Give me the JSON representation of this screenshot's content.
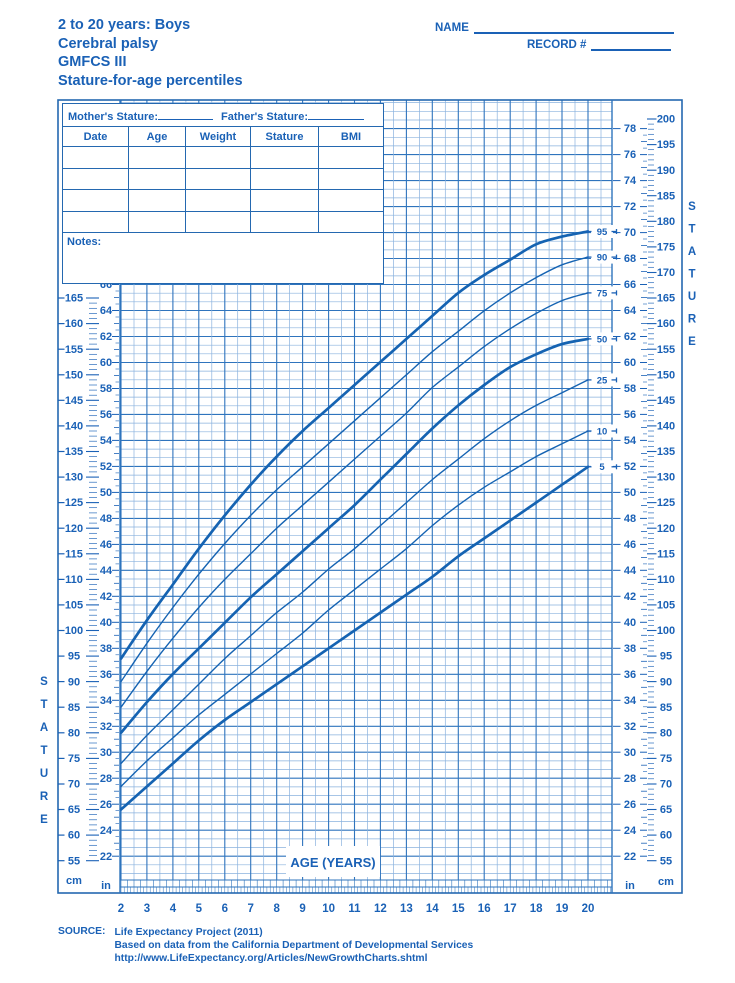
{
  "header": {
    "title_line1": "2 to 20 years: Boys",
    "title_line2": "Cerebral palsy",
    "title_line3": "GMFCS III",
    "title_line4": "Stature-for-age percentiles",
    "name_label": "NAME",
    "record_label": "RECORD #"
  },
  "entry_table": {
    "mother_label": "Mother's Stature:",
    "father_label": "Father's Stature:",
    "columns": [
      "Date",
      "Age",
      "Weight",
      "Stature",
      "BMI"
    ],
    "empty_rows": 4,
    "notes_label": "Notes:"
  },
  "colors": {
    "accent": "#1a61b6",
    "grid_minor": "#8ab2de",
    "grid_major": "#2f74bd",
    "border": "#2468b0",
    "curve": "#1563b2"
  },
  "chart_data": {
    "type": "line",
    "title": "Stature-for-age percentiles, 2 to 20 years, boys with cerebral palsy GMFCS III",
    "xlabel": "AGE (YEARS)",
    "ylabel": "STATURE",
    "unit_cm": "cm",
    "unit_in": "in",
    "x_range": [
      2,
      20
    ],
    "y_range_cm": [
      55,
      200
    ],
    "x_ticks": [
      2,
      3,
      4,
      5,
      6,
      7,
      8,
      9,
      10,
      11,
      12,
      13,
      14,
      15,
      16,
      17,
      18,
      19,
      20
    ],
    "left_cm_labels": [
      165,
      160,
      155,
      150,
      145,
      140,
      135,
      130,
      125,
      120,
      115,
      110,
      105,
      100,
      95,
      90,
      85,
      80,
      75,
      70,
      65,
      60,
      55
    ],
    "left_in_labels": [
      66,
      64,
      62,
      60,
      58,
      56,
      54,
      52,
      50,
      48,
      46,
      44,
      42,
      40,
      38,
      36,
      34,
      32,
      30,
      28,
      26,
      24,
      22
    ],
    "right_cm_labels": [
      200,
      195,
      190,
      185,
      180,
      175,
      170,
      165,
      160,
      155,
      150,
      145,
      140,
      135,
      130,
      125,
      120,
      115,
      110,
      105,
      100,
      95,
      90,
      85,
      80,
      75,
      70,
      65,
      60,
      55
    ],
    "right_in_labels": [
      78,
      76,
      74,
      72,
      70,
      68,
      66,
      64,
      62,
      60,
      58,
      56,
      54,
      52,
      50,
      48,
      46,
      44,
      42,
      40,
      38,
      36,
      34,
      32,
      30,
      28,
      26,
      24,
      22
    ],
    "ages": [
      2,
      3,
      4,
      5,
      6,
      7,
      8,
      9,
      10,
      11,
      12,
      13,
      14,
      15,
      16,
      17,
      18,
      19,
      20
    ],
    "series": [
      {
        "name": "95",
        "weight": "major",
        "values": [
          94.5,
          102,
          109,
          116,
          122.5,
          128.5,
          134,
          139,
          143.5,
          148,
          152.5,
          157,
          161.5,
          166,
          169.5,
          172.5,
          175.5,
          177,
          178
        ]
      },
      {
        "name": "90",
        "weight": "minor",
        "values": [
          90,
          97.5,
          104.5,
          111,
          117,
          122.5,
          127.5,
          132,
          136.5,
          141,
          145.5,
          150,
          154.5,
          158.5,
          162.5,
          166,
          169,
          171.5,
          173
        ]
      },
      {
        "name": "75",
        "weight": "minor",
        "values": [
          85,
          92,
          98.5,
          104.5,
          110,
          115,
          120,
          124.5,
          129,
          133.5,
          138,
          142.5,
          147.5,
          151.5,
          155.5,
          159,
          162,
          164.5,
          166
        ]
      },
      {
        "name": "50",
        "weight": "major",
        "values": [
          80,
          86,
          91.5,
          96.5,
          101.5,
          106.5,
          111,
          115.5,
          120,
          124.5,
          129.5,
          134.5,
          139.5,
          144,
          148,
          151.5,
          154,
          156,
          157
        ]
      },
      {
        "name": "25",
        "weight": "minor",
        "values": [
          74,
          79.5,
          84.5,
          89.5,
          94.5,
          99,
          103.5,
          107.5,
          112,
          116,
          120.5,
          125,
          129.5,
          133.5,
          137.5,
          141,
          144,
          146.5,
          149
        ]
      },
      {
        "name": "10",
        "weight": "minor",
        "values": [
          69.5,
          74.5,
          79,
          83.5,
          87.5,
          91.5,
          95.5,
          99.5,
          104,
          108,
          112,
          116,
          120.5,
          124.5,
          128,
          131,
          134,
          136.5,
          139
        ]
      },
      {
        "name": "5",
        "weight": "major",
        "values": [
          65,
          69.5,
          74,
          78.5,
          82.5,
          86,
          89.5,
          93,
          96.5,
          100,
          103.5,
          107,
          110.5,
          114.5,
          118,
          121.5,
          125,
          128.5,
          132
        ]
      }
    ]
  },
  "footer": {
    "source_label": "SOURCE:",
    "line1": "Life Expectancy Project (2011)",
    "line2": "Based on data from the California Department of Developmental Services",
    "line3": "http://www.LifeExpectancy.org/Articles/NewGrowthCharts.shtml"
  }
}
